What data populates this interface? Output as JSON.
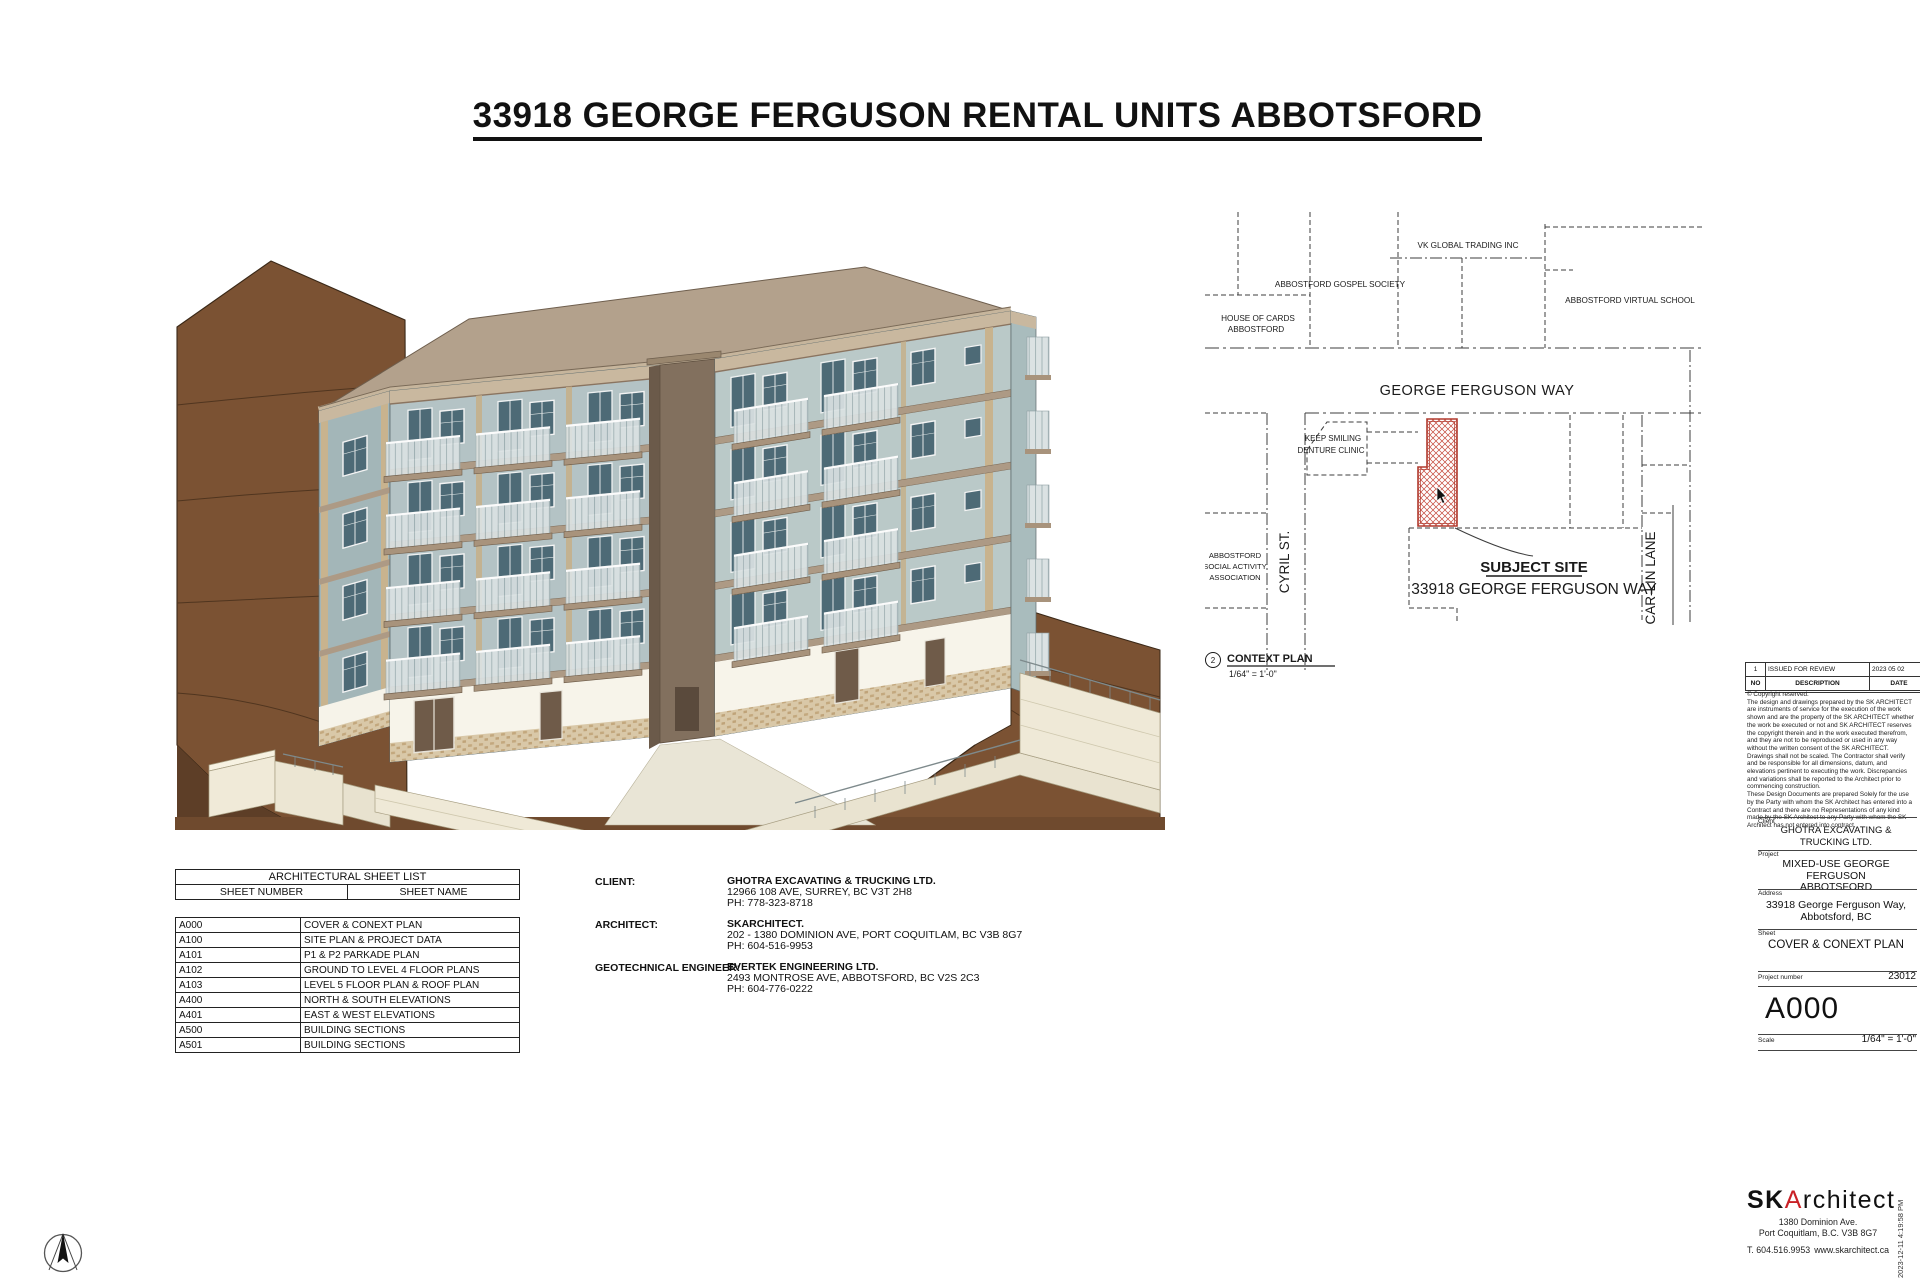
{
  "sheet": {
    "title": "33918 GEORGE FERGUSON RENTAL UNITS ABBOTSFORD"
  },
  "context_plan": {
    "labels": {
      "gospel": "ABBOSTFORD GOSPEL SOCIETY",
      "house": [
        "HOUSE OF CARDS",
        "ABBOSTFORD"
      ],
      "vk": "VK GLOBAL TRADING INC",
      "virtual": "ABBOSTFORD VIRTUAL SCHOOL",
      "denture": [
        "KEEP SMILING",
        "DENTURE CLINIC"
      ],
      "social": [
        "ABBOSTFORD",
        "SOCIAL ACTIVITY",
        "ASSOCIATION"
      ]
    },
    "street_top": "GEORGE FERGUSON WAY",
    "street_left": "CYRIL ST.",
    "street_right": "CAR-LIN LANE",
    "subject_site_label": "SUBJECT SITE",
    "subject_site_address": "33918 GEORGE FERGUSON WAY",
    "detail_number": "2",
    "detail_title": "CONTEXT PLAN",
    "detail_scale": "1/64\" = 1'-0\"",
    "subject_hatch_color": "#b03a2e"
  },
  "sheet_list": {
    "title": "ARCHITECTURAL SHEET LIST",
    "columns": [
      "SHEET NUMBER",
      "SHEET NAME"
    ],
    "rows": [
      [
        "A000",
        "COVER & CONEXT PLAN"
      ],
      [
        "A100",
        "SITE PLAN & PROJECT DATA"
      ],
      [
        "A101",
        "P1 & P2 PARKADE PLAN"
      ],
      [
        "A102",
        "GROUND TO LEVEL 4 FLOOR PLANS"
      ],
      [
        "A103",
        "LEVEL 5 FLOOR PLAN & ROOF PLAN"
      ],
      [
        "A400",
        "NORTH & SOUTH ELEVATIONS"
      ],
      [
        "A401",
        "EAST & WEST ELEVATIONS"
      ],
      [
        "A500",
        "BUILDING SECTIONS"
      ],
      [
        "A501",
        "BUILDING SECTIONS"
      ]
    ]
  },
  "consultants": [
    {
      "role": "CLIENT:",
      "name": "GHOTRA EXCAVATING & TRUCKING LTD.",
      "address": "12966 108 AVE, SURREY, BC V3T 2H8",
      "phone": "PH: 778-323-8718"
    },
    {
      "role": "ARCHITECT:",
      "name": "SKARCHITECT.",
      "address": "202 - 1380 DOMINION AVE, PORT COQUITLAM, BC V3B 8G7",
      "phone": "PH: 604-516-9953"
    },
    {
      "role": "GEOTECHNICAL ENGINEER:",
      "name": "EVERTEK ENGINEERING LTD.",
      "address": "2493 MONTROSE AVE, ABBOTSFORD, BC V2S 2C3",
      "phone": "PH: 604-776-0222"
    }
  ],
  "title_block": {
    "revision": {
      "no": "1",
      "description": "ISSUED FOR REVIEW",
      "date": "2023 05 02",
      "header": {
        "no": "NO",
        "description": "DESCRIPTION",
        "date": "DATE"
      }
    },
    "copyright": "© Copyright reserved.\nThe design and drawings prepared by the SK ARCHITECT are instruments of service for the execution of the work shown and are the property of the SK ARCHITECT whether the work be executed or not and SK ARCHITECT reserves the copyright therein and in the work executed therefrom, and they are not to be reproduced or used in any way without the written consent of the SK ARCHITECT.\nDrawings shall not be scaled.  The Contractor shall verify and be responsible for all dimensions, datum, and elevations pertinent to executing the work.  Discrepancies and variations shall be reported to the Architect prior to commencing construction.\nThese Design Documents are prepared Solely for the use by the Party with whom the SK Architect has entered into a Contract and there are no Representations of any kind made by the SK Architect to any Party with whom the SK Architect has not entered into contract.",
    "client_label": "Client",
    "client_lines": [
      "GHOTRA EXCAVATING &",
      "TRUCKING LTD."
    ],
    "project_label": "Project",
    "project_lines": [
      "MIXED-USE GEORGE FERGUSON",
      "ABBOTSFORD"
    ],
    "address_label": "Address",
    "address_lines": [
      "33918 George Ferguson Way,",
      "Abbotsford, BC"
    ],
    "sheet_label": "Sheet",
    "sheet_name": "COVER & CONEXT PLAN",
    "project_number_label": "Project number",
    "project_number": "23012",
    "sheet_number": "A000",
    "scale_label": "Scale",
    "scale": "1/64\" = 1'-0\""
  },
  "firm": {
    "logo_sk": "SK",
    "logo_a": "A",
    "logo_rest": "rchitect",
    "accent_color": "#c92127",
    "address1": "1380 Dominion Ave.",
    "address2": "Port Coquitlam, B.C. V3B 8G7",
    "phone": "T. 604.516.9953",
    "website": "www.skarchitect.ca"
  },
  "timestamp": "2023-12-11 4:19:58 PM",
  "colors": {
    "terrain": "#7b5233",
    "terrain_dark": "#5d3e27",
    "wall_blue_gray": "#b4c3c5",
    "roof_tan": "#b3a18c",
    "base_cream": "#efe9d7",
    "window_glass": "#4d6a76"
  }
}
